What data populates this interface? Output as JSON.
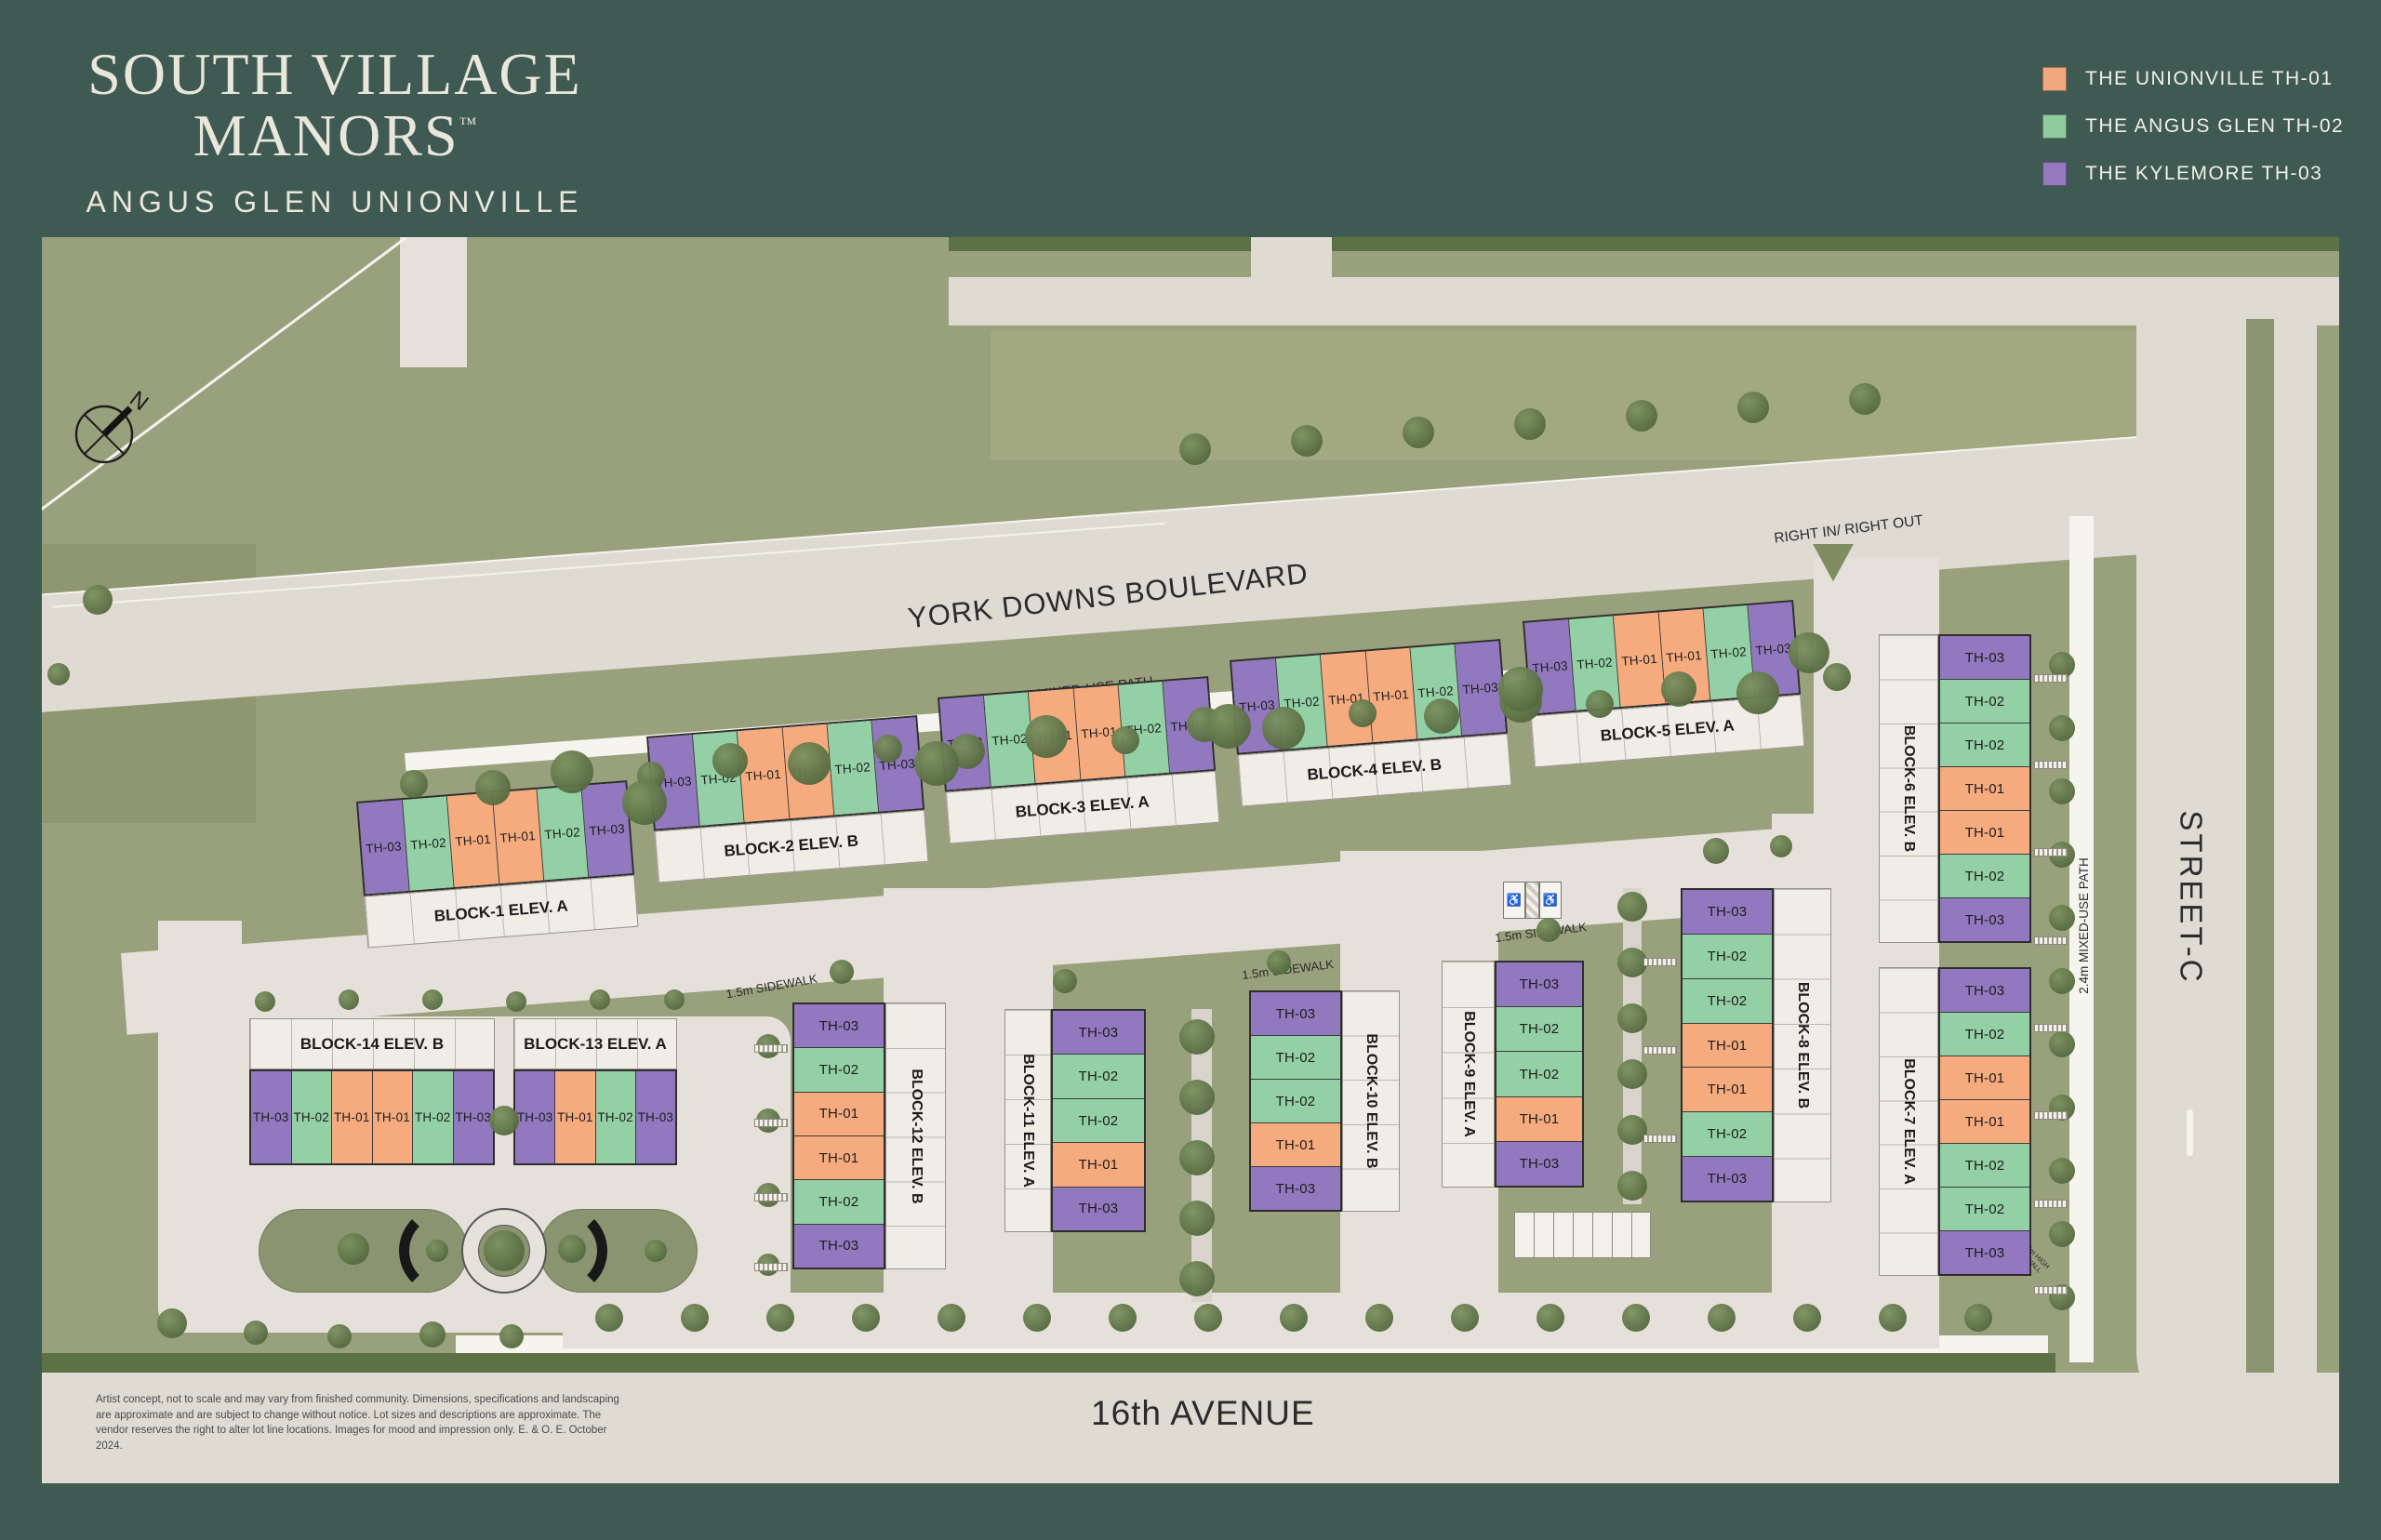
{
  "brand": {
    "title_line1": "SOUTH VILLAGE",
    "title_line2": "MANORS",
    "trademark": "™",
    "subtitle": "ANGUS GLEN UNIONVILLE"
  },
  "legend": {
    "items": [
      {
        "label": "THE UNIONVILLE TH-01",
        "color": "#F2A87D"
      },
      {
        "label": "THE ANGUS GLEN TH-02",
        "color": "#8FCB9E"
      },
      {
        "label": "THE KYLEMORE TH-03",
        "color": "#9678BE"
      }
    ]
  },
  "unit_colors": {
    "TH-01": "#F5AB7E",
    "TH-02": "#93D0A5",
    "TH-03": "#9278BE"
  },
  "map": {
    "north_label": "N",
    "streets": {
      "york_downs": "YORK DOWNS BOULEVARD",
      "sixteenth": "16th AVENUE",
      "street_c": "STREET-C"
    },
    "paths": {
      "p3m": "3m MIXED-USE PATH",
      "p24_bottom": "2.4m MIXED-USE PATH",
      "p24_right": "2.4m MIXED-USE PATH",
      "sw_west": "1.5m SIDEWALK",
      "sw_mid": "1.5m SIDEWALK",
      "sw_east": "1.5m SIDEWALK"
    },
    "junction": "RIGHT IN/ RIGHT OUT",
    "retaining_wall": "0.5m TO 1.5m HIGH RETAINING WALL",
    "accessible_icon": "♿",
    "blocks": [
      {
        "id": "block-1",
        "label": "BLOCK-1 ELEV. A",
        "units": [
          "TH-03",
          "TH-02",
          "TH-01",
          "TH-01",
          "TH-02",
          "TH-03"
        ]
      },
      {
        "id": "block-2",
        "label": "BLOCK-2 ELEV. B",
        "units": [
          "TH-03",
          "TH-02",
          "TH-01",
          "TH-01",
          "TH-02",
          "TH-03"
        ]
      },
      {
        "id": "block-3",
        "label": "BLOCK-3 ELEV. A",
        "units": [
          "TH-03",
          "TH-02",
          "TH-01",
          "TH-01",
          "TH-02",
          "TH-03"
        ]
      },
      {
        "id": "block-4",
        "label": "BLOCK-4 ELEV. B",
        "units": [
          "TH-03",
          "TH-02",
          "TH-01",
          "TH-01",
          "TH-02",
          "TH-03"
        ]
      },
      {
        "id": "block-5",
        "label": "BLOCK-5 ELEV. A",
        "units": [
          "TH-03",
          "TH-02",
          "TH-01",
          "TH-01",
          "TH-02",
          "TH-03"
        ]
      },
      {
        "id": "block-6",
        "label": "BLOCK-6 ELEV. B",
        "units": [
          "TH-03",
          "TH-02",
          "TH-02",
          "TH-01",
          "TH-01",
          "TH-02",
          "TH-03"
        ]
      },
      {
        "id": "block-7",
        "label": "BLOCK-7 ELEV. A",
        "units": [
          "TH-03",
          "TH-02",
          "TH-01",
          "TH-01",
          "TH-02",
          "TH-02",
          "TH-03"
        ]
      },
      {
        "id": "block-8",
        "label": "BLOCK-8 ELEV. B",
        "units": [
          "TH-03",
          "TH-02",
          "TH-02",
          "TH-01",
          "TH-01",
          "TH-02",
          "TH-03"
        ]
      },
      {
        "id": "block-9",
        "label": "BLOCK-9 ELEV. A",
        "units": [
          "TH-03",
          "TH-02",
          "TH-02",
          "TH-01",
          "TH-03"
        ]
      },
      {
        "id": "block-10",
        "label": "BLOCK-10 ELEV. B",
        "units": [
          "TH-03",
          "TH-02",
          "TH-02",
          "TH-01",
          "TH-03"
        ]
      },
      {
        "id": "block-11",
        "label": "BLOCK-11 ELEV. A",
        "units": [
          "TH-03",
          "TH-02",
          "TH-02",
          "TH-01",
          "TH-03"
        ]
      },
      {
        "id": "block-12",
        "label": "BLOCK-12 ELEV. B",
        "units": [
          "TH-03",
          "TH-02",
          "TH-01",
          "TH-01",
          "TH-02",
          "TH-03"
        ]
      },
      {
        "id": "block-13",
        "label": "BLOCK-13 ELEV. A",
        "units": [
          "TH-03",
          "TH-01",
          "TH-02",
          "TH-03"
        ]
      },
      {
        "id": "block-14",
        "label": "BLOCK-14 ELEV. B",
        "units": [
          "TH-03",
          "TH-02",
          "TH-01",
          "TH-01",
          "TH-02",
          "TH-03"
        ]
      }
    ]
  },
  "disclaimer": "Artist concept, not to scale and may vary from finished community. Dimensions, specifications and landscaping are approximate and are subject to change without notice. Lot sizes and descriptions are approximate. The vendor reserves the right to alter lot line locations. Images for mood and impression only. E. & O. E. October 2024."
}
